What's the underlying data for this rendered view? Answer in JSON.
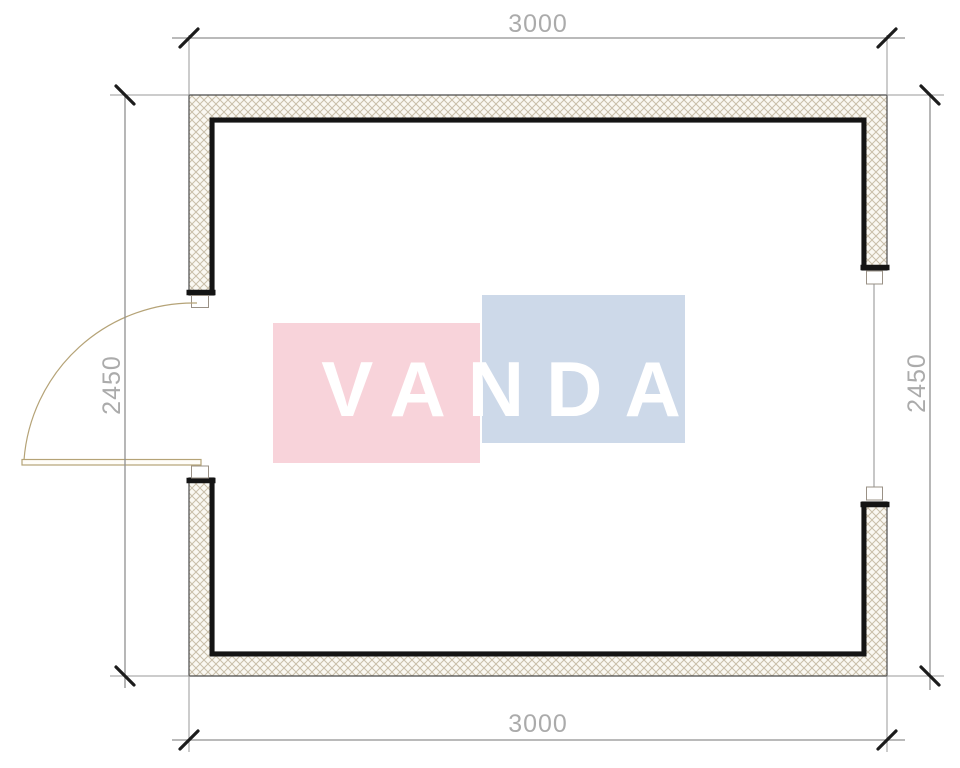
{
  "dimensions": {
    "top": "3000",
    "bottom": "3000",
    "left": "2450",
    "right": "2450"
  },
  "watermark": {
    "text": "VANDA",
    "pink_color": "#f8d3da",
    "blue_color": "#cdd9e9",
    "text_color": "#ffffff"
  },
  "colors": {
    "wall_hatch_line": "#c9bfa9",
    "wall_hatch_bg": "#faf8f2",
    "wall_thin_outline": "#4a4a4a",
    "wall_heavy_line": "#141414",
    "jamb_outline": "#9a9186",
    "door_line": "#b5a377",
    "dimension_line": "#909090",
    "tick_mark": "#1c1c1c",
    "dimension_text": "#ababab"
  }
}
